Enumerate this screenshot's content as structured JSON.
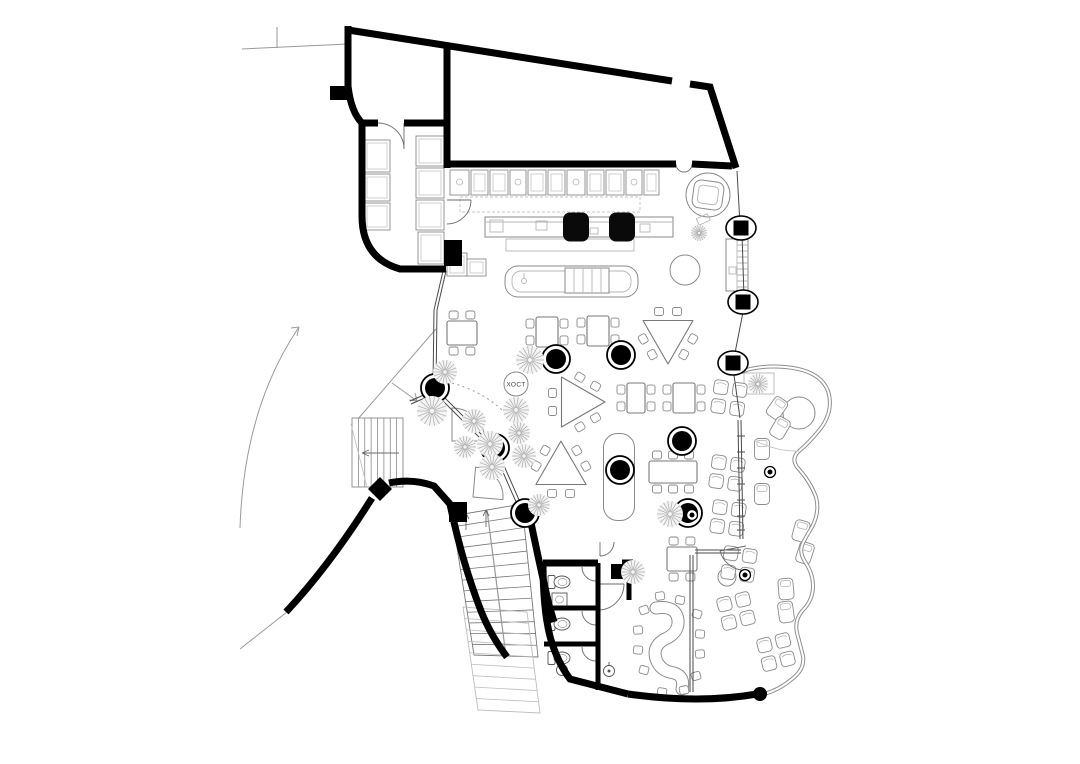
{
  "labels": {
    "host_station": {
      "text": "ХОСТ"
    }
  },
  "colors": {
    "wall": "#000000",
    "furniture": "#8a8a8a",
    "glass": "#4a4a4a",
    "plant": "#b2b2b2",
    "terrace_wall": "#8f8f8f",
    "background": "#ffffff"
  },
  "plan": {
    "columns_round": [
      [
        435,
        388
      ],
      [
        495,
        448
      ],
      [
        525,
        513
      ],
      [
        556,
        359
      ],
      [
        621,
        355
      ],
      [
        620,
        470
      ],
      [
        682,
        441
      ],
      [
        688,
        513
      ]
    ],
    "columns_square": [
      [
        741,
        228
      ],
      [
        743,
        302
      ],
      [
        733,
        363
      ]
    ],
    "bar_columns": [
      [
        576,
        227
      ],
      [
        622,
        227
      ]
    ],
    "small_columns": [
      [
        770,
        472
      ],
      [
        745,
        575
      ],
      [
        692,
        515
      ]
    ],
    "wall_end_dots": [
      [
        760,
        694
      ]
    ],
    "plants": [
      [
        530,
        360,
        14
      ],
      [
        445,
        372,
        12
      ],
      [
        432,
        411,
        15
      ],
      [
        474,
        421,
        12
      ],
      [
        490,
        444,
        13
      ],
      [
        516,
        410,
        13
      ],
      [
        519,
        433,
        11
      ],
      [
        524,
        456,
        12
      ],
      [
        492,
        467,
        13
      ],
      [
        465,
        447,
        11
      ],
      [
        539,
        505,
        11
      ],
      [
        633,
        572,
        12
      ],
      [
        670,
        514,
        13
      ],
      [
        758,
        384,
        10
      ],
      [
        699,
        233,
        8
      ]
    ],
    "tables_square": [
      [
        462,
        333,
        30,
        24,
        "tb"
      ],
      [
        547,
        332,
        22,
        30,
        "lr"
      ],
      [
        598,
        331,
        22,
        30,
        "lr"
      ],
      [
        636,
        398,
        18,
        30,
        "lr"
      ],
      [
        684,
        398,
        22,
        30,
        "lr"
      ],
      [
        682,
        559,
        30,
        24,
        "tb"
      ]
    ],
    "tables_rect6": [
      [
        673,
        472,
        48,
        22
      ]
    ],
    "tables_triangle": [
      [
        668,
        335,
        0
      ],
      [
        576,
        402,
        -90
      ],
      [
        561,
        470,
        -60
      ]
    ],
    "round_tables": [
      [
        685,
        270,
        15
      ],
      [
        799,
        413,
        16
      ],
      [
        727,
        577,
        9
      ]
    ],
    "high_tables": [
      [
        619,
        477,
        31,
        87
      ]
    ],
    "armchair_clusters": [
      [
        729,
        398,
        8
      ],
      [
        727,
        473,
        8
      ],
      [
        728,
        518,
        8
      ],
      [
        739,
        564,
        8
      ],
      [
        736,
        611,
        -14
      ],
      [
        776,
        652,
        -14
      ]
    ],
    "lounge_chairs": [
      [
        762,
        449,
        0
      ],
      [
        762,
        494,
        0
      ],
      [
        801,
        531,
        15
      ],
      [
        805,
        553,
        18
      ],
      [
        786,
        589,
        -5
      ],
      [
        786,
        612,
        -8
      ],
      [
        777,
        408,
        35
      ],
      [
        780,
        428,
        30
      ]
    ],
    "booth_chairs": [
      [
        644,
        610,
        -20
      ],
      [
        638,
        630,
        -5
      ],
      [
        638,
        650,
        5
      ],
      [
        644,
        670,
        15
      ],
      [
        697,
        614,
        20
      ],
      [
        700,
        634,
        5
      ],
      [
        700,
        654,
        -5
      ],
      [
        696,
        676,
        -15
      ],
      [
        660,
        596,
        -8
      ],
      [
        680,
        600,
        10
      ],
      [
        662,
        692,
        8
      ],
      [
        684,
        690,
        -10
      ]
    ],
    "toilets": [
      [
        559,
        582
      ],
      [
        559,
        624
      ],
      [
        559,
        658
      ]
    ],
    "sinks_round": [
      [
        562,
        670
      ],
      [
        609,
        671
      ]
    ],
    "sink_rect": [
      552,
      593,
      15,
      13
    ],
    "kitchen_units_top": [
      [
        450,
        19
      ],
      [
        471,
        17
      ],
      [
        490,
        18
      ],
      [
        510,
        16
      ],
      [
        528,
        18
      ],
      [
        548,
        17
      ],
      [
        567,
        18
      ],
      [
        587,
        17
      ],
      [
        606,
        18
      ],
      [
        626,
        16
      ],
      [
        644,
        15
      ]
    ],
    "kitchen_units_left": [
      [
        364,
        140,
        26,
        32
      ],
      [
        364,
        174,
        26,
        27
      ],
      [
        364,
        203,
        26,
        27
      ],
      [
        416,
        136,
        28,
        30
      ],
      [
        416,
        168,
        28,
        30
      ],
      [
        416,
        200,
        28,
        30
      ],
      [
        418,
        232,
        26,
        32
      ],
      [
        447,
        253,
        20,
        23
      ],
      [
        467,
        259,
        19,
        17
      ]
    ],
    "stairs_ext": {
      "x": 352,
      "y": 418,
      "w": 51,
      "h": 69,
      "treads": 7
    },
    "stairs_main": {
      "tl": [
        452,
        516
      ],
      "tr": [
        522,
        504
      ],
      "bl": [
        474,
        655
      ],
      "br": [
        538,
        657
      ],
      "treads": 13
    },
    "stairs_lower": {
      "tl": [
        463,
        607
      ],
      "tr": [
        527,
        612
      ],
      "bl": [
        478,
        710
      ],
      "br": [
        540,
        713
      ],
      "treads": 9
    }
  }
}
